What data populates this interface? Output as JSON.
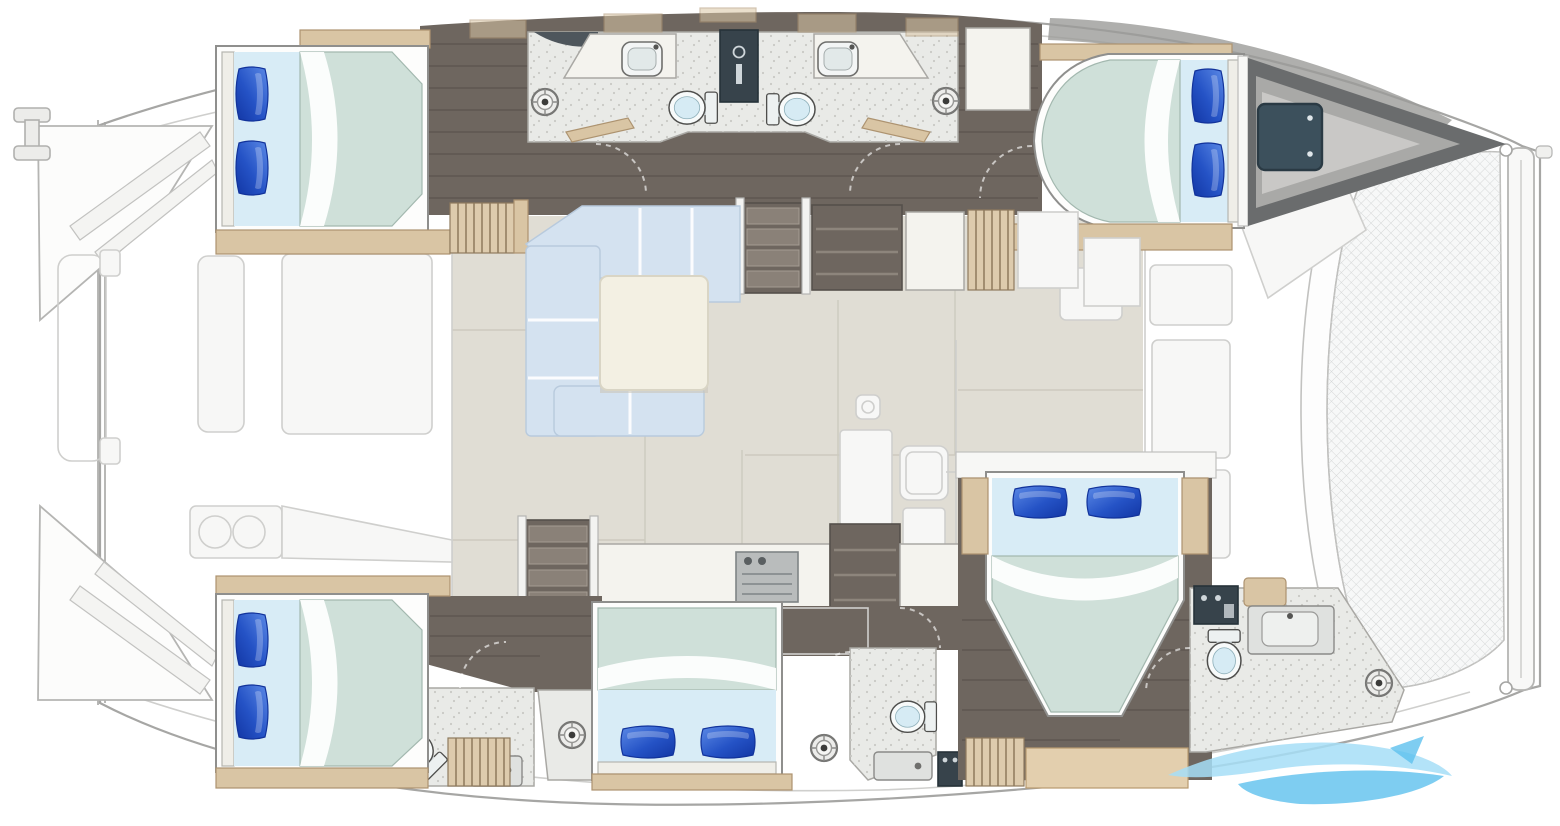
{
  "scene": {
    "kind": "catamaran-yacht-deck-plan",
    "view": "top-down",
    "bow_direction": "right",
    "hulls": 2
  },
  "inventory": {
    "double_berths": 5,
    "blue_pillows": 10,
    "toilets": 5,
    "head_sinks": 2,
    "shower_drains": 5,
    "companionway_stairs": 2,
    "trampolines": 1,
    "salon_sofas": 1,
    "salon_tables": 1,
    "stove_tops": 1
  },
  "rooms": {
    "port_hull": {
      "aft_cabin": "double berth, pillows outboard",
      "amidships": "two head compartments with sinks, toilets and shower drains",
      "forward_cabin": "double berth, pillows forward",
      "bow": "forepeak locker with dark deck hatch"
    },
    "main_deck": {
      "aft": "cockpit with bench, table and twin round sinks (ghosted)",
      "salon": "L-shaped sofa with square coffee table",
      "galley": "counters with sink, stove top and lockers",
      "forward": "foredeck and trampoline"
    },
    "starboard_hull": {
      "aft_cabin": "double berth with en-suite head and shower",
      "mid_cabin": "double berth, pillows aft",
      "mid_head": "head with toilet, vanity and shower drain",
      "owner_cabin": "island double berth with nightstands",
      "owner_en_suite": "head with toilet, vanity, wet locker and shower drain"
    }
  },
  "watermark": {
    "icon": "wave-swoosh-logo",
    "position": "bottom-right"
  },
  "colors": {
    "hull_line": "#a6a6a4",
    "ghost_line": "#cfcfcd",
    "ghost_fill": "#f7f7f6",
    "roof_gray": "#9b9b99",
    "salon_floor": "#e0ddd4",
    "tile_seam": "#cdcabf",
    "wood_floor": "#6e665f",
    "wood_line": "#4e463f",
    "trim_tan": "#d9c5a4",
    "trim_edge": "#ad9370",
    "slat_tan": "#ddcbad",
    "slat_line": "#8f7b5e",
    "duvet": "#cfe0d9",
    "duvet_edge": "#a3b8af",
    "sheet_blue": "#d8ecf6",
    "sofa_blue": "#d4e2f0",
    "sofa_seam": "#ffffff",
    "table_cream": "#f3f0e3",
    "table_edge": "#d9d5c5",
    "counter_white": "#f4f3ee",
    "counter_line": "#a9a8a4",
    "bath_floor": "#e9eae7",
    "speckle": "#c9c9c5",
    "dark_panel": "#37434b",
    "dark_panel_edge": "#263239",
    "tread": "#8a8178",
    "forepeak_dark": "#6a6c6d",
    "forepeak_mid": "#a9a9a7",
    "forepeak_light": "#c9c8c6",
    "hatch_teal": "#3c505c",
    "tramp_bg": "#f7f8f8",
    "tramp_line": "#d6d8d8",
    "toilet_white": "#f7fafa",
    "toilet_inner": "#d6ebf4",
    "steel": "#dfe1df",
    "steel_edge": "#8a8a88",
    "stove_gray": "#b9bcbc",
    "pillow_highlight": "#5c8ae6",
    "pillow_deep": "#1236a4",
    "pillow_edge": "#12339b",
    "wm_light": "#a6def7",
    "wm_mid": "#5ec1ee"
  }
}
